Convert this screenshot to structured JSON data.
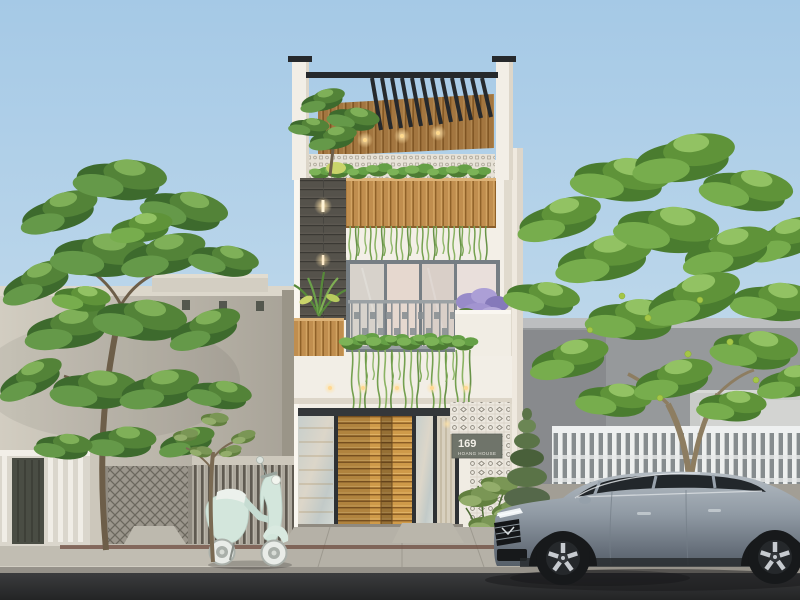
{
  "image": {
    "kind": "3D architectural exterior render",
    "description": "Three-storey modern tube house at dusk: rooftop pergola with wood ceiling and downlights, hanging-plant planters, dark stone feature wall with sconces, sliding glass doors behind a metal railing balcony, golden wood-slat entrance gate, white patterned breeze-block wall with address sign. A gray sedan and a mint scooter are parked on the street; neighbouring low gray houses with fences and large green trees flank the house."
  },
  "sign": {
    "number": "169",
    "name": "HOANG HOUSE"
  },
  "objects": {
    "main_house": [
      "rooftop pergola",
      "rooftop tree and planter with hanging vines",
      "breeze-block parapet",
      "dark stone wall with sconce lights",
      "sliding glass doors",
      "balcony railing with hanging plants",
      "slab downlights",
      "wood-slat sliding gate",
      "breeze-block facade wall",
      "address sign",
      "entry shrub",
      "purple flower planter"
    ],
    "street": [
      "asphalt road",
      "concrete sidewalk",
      "driveway ramps",
      "drain strip",
      "gray sedan",
      "mint scooter",
      "small sidewalk tree"
    ],
    "neighbors": [
      "left single-storey gray house with roof vents",
      "white fence with dark gate",
      "accordion metal gate",
      "gray slatted fence",
      "right gray house",
      "white picket fence"
    ],
    "vegetation": [
      "left canopy tree",
      "right canopy tree with green fruits",
      "rooftop tree",
      "conifer shrub",
      "balcony and planter vines"
    ]
  },
  "palette": {
    "sky_top": "#a5c9e6",
    "sky_bottom": "#dbe9f1",
    "facade_white": "#f3efe7",
    "wood": "#cf9a49",
    "dark_frame": "#2e3134",
    "stone_wall": "#55524b",
    "breeze_block": "#ece8df",
    "sign_plate": "#6f746a",
    "road": "#38393b",
    "sidewalk": "#c1bdb2",
    "left_house": "#c9c4b9",
    "right_house": "#96999b",
    "car_body": "#8e98a2",
    "scooter_body": "#d3e6dc",
    "foliage_dark": "#3d6a2d",
    "foliage_bright": "#77ad4d",
    "fruit": "#a4c647",
    "flowers": "#ac9fd6",
    "downlight": "#ffd98d"
  }
}
